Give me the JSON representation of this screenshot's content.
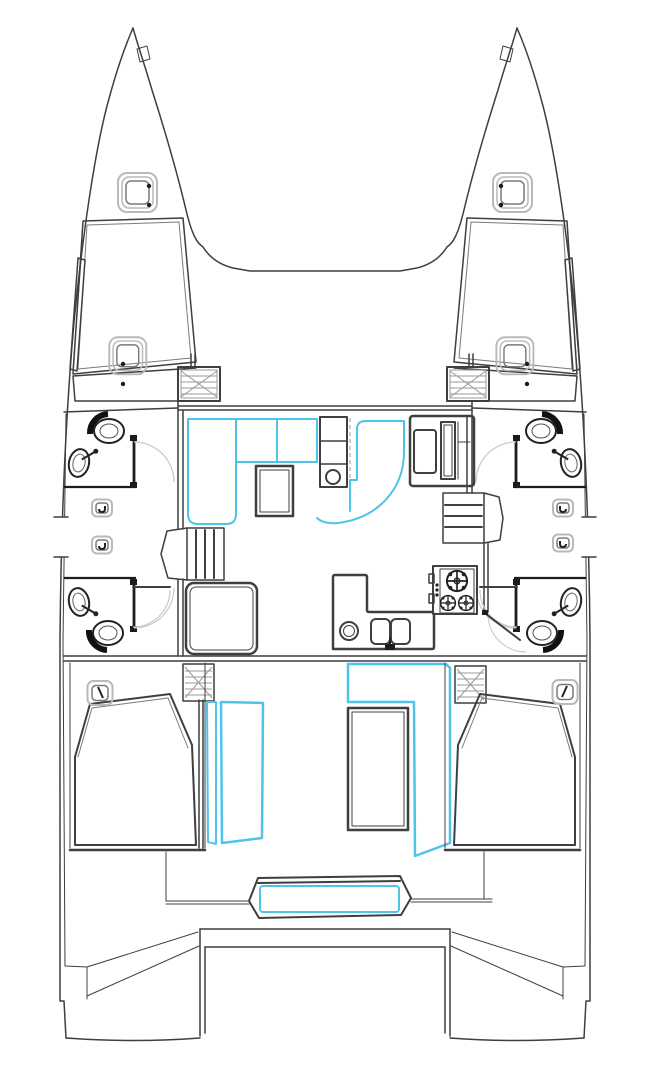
{
  "canvas": {
    "viewbox": "0 0 650 1080",
    "width": 650,
    "height": 1080
  },
  "colors": {
    "background": "#ffffff",
    "line": "#3f3f3f",
    "wall": "#1c1c1c",
    "detail": "#7a7a7a",
    "light": "#b9b9b9",
    "hatch": "#9a9a9a",
    "accent": "#4fc3ea"
  },
  "drawing": {
    "kind": "catamaran-floor-plan",
    "features": {
      "hulls": 2,
      "bow_deck_hatches": 2,
      "foredeck_hatches": 2,
      "forward_cabin_window_strips": 2,
      "heads_compartments": 4,
      "toilets": 4,
      "bathroom_sinks": 4,
      "hull_portholes": 4,
      "companionway_steps": 2,
      "saloon_settee_sections_highlighted": 3,
      "saloon_table": 1,
      "nav_seat": 1,
      "galley_burners": 3,
      "galley_round_sink": 1,
      "galley_double_sink_bowls": 2,
      "cockpit_table": 1,
      "cockpit_highlighted_panels": 3,
      "aft_double_berths": 2,
      "aft_berth_hatches": 2,
      "stern_bench_highlighted": 1,
      "transom_platforms": 2
    }
  }
}
